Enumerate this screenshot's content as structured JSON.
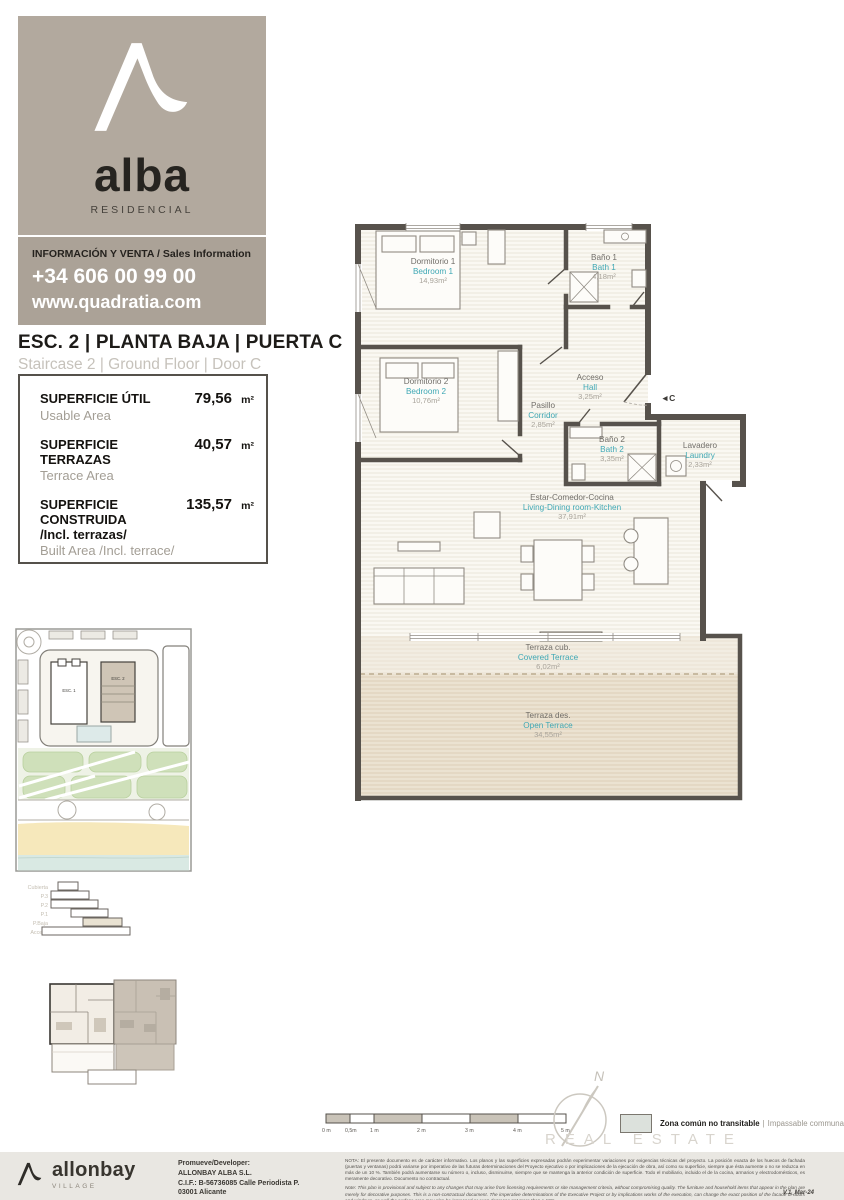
{
  "brand": {
    "word": "alba",
    "sub": "RESIDENCIAL",
    "info": "INFORMACIÓN Y VENTA / Sales Information",
    "phone": "+34 606 00 99 00",
    "web": "www.quadratia.com"
  },
  "unit": {
    "t_es": "ESC. 2 | PLANTA BAJA | PUERTA C",
    "t_en": "Staircase 2 | Ground Floor | Door C"
  },
  "areas": [
    {
      "es": "SUPERFICIE ÚTIL",
      "es2": "",
      "en": "Usable Area",
      "value": "79,56",
      "unit": "m²"
    },
    {
      "es": "SUPERFICIE TERRAZAS",
      "es2": "",
      "en": "Terrace Area",
      "value": "40,57",
      "unit": "m²"
    },
    {
      "es": "SUPERFICIE CONSTRUIDA",
      "es2": "/Incl. terrazas/",
      "en": "Built Area /Incl. terrace/",
      "value": "135,57",
      "unit": "m²"
    }
  ],
  "floorplan": {
    "door_marker": "◄C",
    "rooms": [
      {
        "es": "Dormitorio 1",
        "en": "Bedroom 1",
        "area": "14,93m²"
      },
      {
        "es": "Baño 1",
        "en": "Bath 1",
        "area": "4,18m²"
      },
      {
        "es": "Dormitorio 2",
        "en": "Bedroom 2",
        "area": "10,76m²"
      },
      {
        "es": "Pasillo",
        "en": "Corridor",
        "area": "2,85m²"
      },
      {
        "es": "Acceso",
        "en": "Hall",
        "area": "3,25m²"
      },
      {
        "es": "Baño 2",
        "en": "Bath 2",
        "area": "3,35m²"
      },
      {
        "es": "Lavadero",
        "en": "Laundry",
        "area": "2,33m²"
      },
      {
        "es": "Estar-Comedor-Cocina",
        "en": "Living-Dining room-Kitchen",
        "area": "37,91m²"
      },
      {
        "es": "Terraza cub.",
        "en": "Covered Terrace",
        "area": "6,02m²"
      },
      {
        "es": "Terraza des.",
        "en": "Open Terrace",
        "area": "34,55m²"
      }
    ]
  },
  "sitemap": {
    "buildings": [
      "ESC. 1",
      "ESC. 2"
    ]
  },
  "levels": [
    "Cubierta",
    "P.3",
    "P.2",
    "P.1",
    "P.Baja",
    "Acceso"
  ],
  "scalebar": [
    "0 m",
    "0,5m",
    "1 m",
    "2 m",
    "3 m",
    "4 m",
    "5 m"
  ],
  "compass": {
    "north": "N"
  },
  "legend": {
    "es": "Zona común no transitable",
    "sep": "|",
    "en": "Impassable communal area"
  },
  "watermark": "REAL ESTATE",
  "footer": {
    "brand": "allonbay",
    "brand_sub": "VILLAGE",
    "dev": [
      "Promueve/Developer:",
      "ALLONBAY ALBA S.L.",
      "C.I.F.: B-56736085 Calle Periodista P.",
      "03001 Alicante"
    ],
    "note_es": "NOTA: El presente documento es de carácter informativo. Los planos y las superficies expresadas podrán experimentar variaciones por exigencias técnicas del proyecto. La posición exacta de los huecos de fachada (puertas y ventanas) podrá variarse por imperativo de las futuras determinaciones del Proyecto ejecutivo o por implicaciones de la ejecución de obra, así como su superficie, siempre que ésta aumente o no se reduzca en más de un 10 %. También podrá aumentarse su número o, incluso, disminuirse, siempre que se mantenga la anterior condición de superficie. Todo el mobiliario, incluido el de la cocina, armarios y electrodomésticos, es meramente decorativo. Documento no contractual.",
    "note_en": "Note: This plan is provisional and subject to any changes that may arise from licensing requirements or site management criteria, without compromising quality. The furniture and household items that appear in the plan are merely for decorative purposes. This is a non-contractual document. The imperative determinations of the Executive Project or by implications works of the execution, can change the exact position of the facade of doors and windows, as well the surface area may also be increased or even decrease not more than a 10%.",
    "version": "V.1_Mar-24"
  }
}
